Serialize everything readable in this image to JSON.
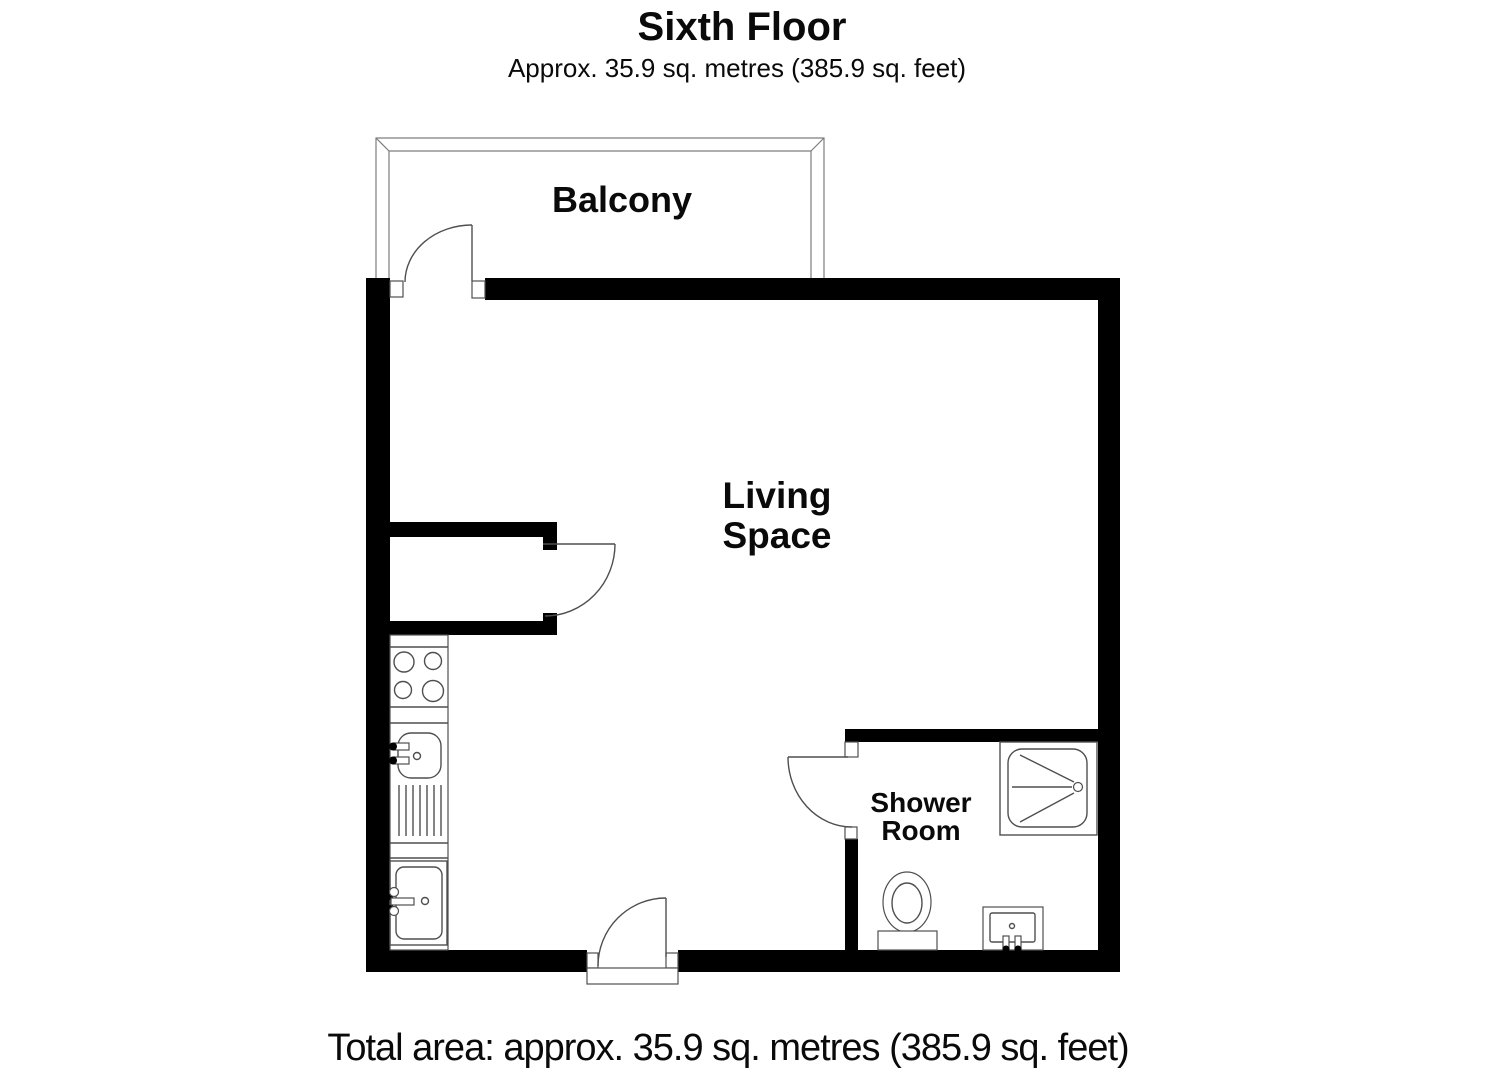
{
  "header": {
    "title": "Sixth Floor",
    "subtitle": "Approx. 35.9 sq. metres (385.9 sq. feet)"
  },
  "rooms": {
    "balcony": {
      "label": "Balcony"
    },
    "living_space": {
      "label_line1": "Living",
      "label_line2": "Space"
    },
    "shower_room": {
      "label_line1": "Shower",
      "label_line2": "Room"
    }
  },
  "footer": {
    "total_area": "Total area: approx. 35.9 sq. metres (385.9 sq. feet)"
  },
  "fixtures": {
    "kitchen": [
      "hob",
      "sink-with-taps",
      "drainer",
      "sink"
    ],
    "shower_room": [
      "shower-tray",
      "toilet",
      "basin"
    ]
  },
  "doors": [
    "balcony-door",
    "closet-door",
    "entrance-door",
    "shower-room-door"
  ],
  "colors": {
    "wall": "#000000",
    "fixture_line": "#4f4f4f",
    "railing_line": "#7d7d7d",
    "text": "#0a0a0a",
    "background": "#ffffff"
  }
}
